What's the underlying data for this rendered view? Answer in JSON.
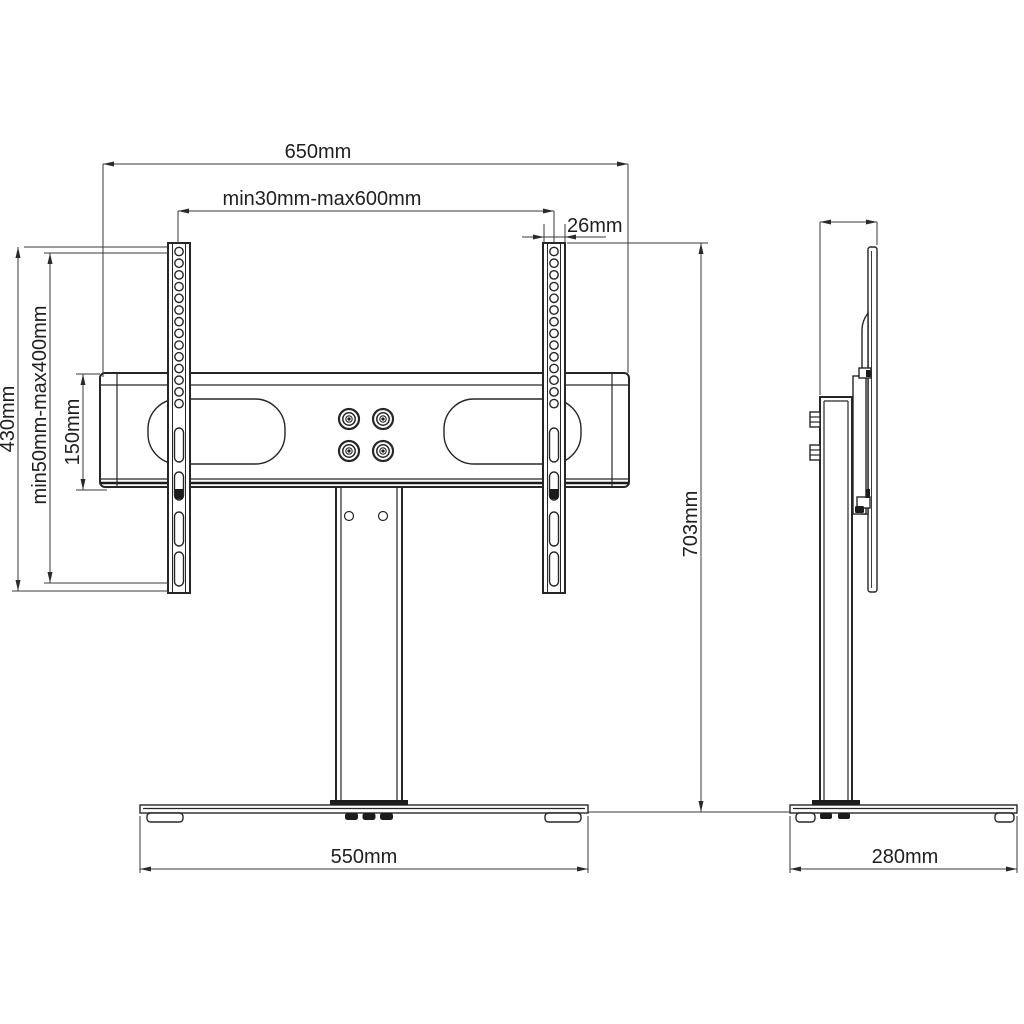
{
  "drawing": {
    "front_view": {
      "dim_total_width": "650mm",
      "dim_rail_span": "min30mm-max600mm",
      "dim_rail_width": "26mm",
      "dim_rail_height": "430mm",
      "dim_hole_range": "min50mm-max400mm",
      "dim_bar_height": "150mm",
      "dim_total_height": "703mm",
      "dim_base_width": "550mm"
    },
    "side_view": {
      "dim_base_depth": "280mm"
    },
    "colors": {
      "line": "#262626",
      "dimension_line": "#3a3a3a",
      "background": "#ffffff"
    }
  }
}
